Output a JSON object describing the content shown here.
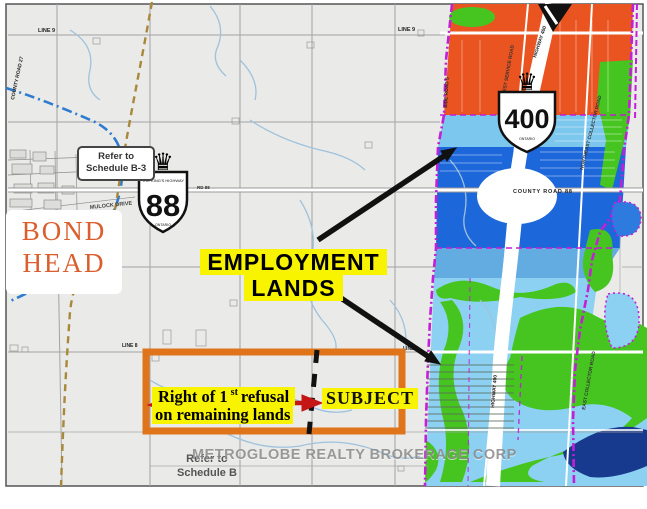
{
  "labels": {
    "bond_head": {
      "line1": "BOND",
      "line2": "HEAD"
    },
    "employment": {
      "line1": "EMPLOYMENT",
      "line2": "LANDS"
    },
    "refusal": {
      "pre": "Right of 1",
      "sup": "st",
      "post": " refusal",
      "line2": "on remaining lands"
    },
    "subject": "SUBJECT",
    "refer_b3": {
      "line1": "Refer to",
      "line2": "Schedule B-3"
    },
    "refer_b": {
      "line1": "Refer to",
      "line2": "Schedule B"
    },
    "watermark": "METROGLOBE REALTY BROKERAGE CORP"
  },
  "roads": {
    "line9_left": "LINE 9",
    "line9_right": "LINE 9",
    "line8_left": "LINE 8",
    "line8_right": "LINE 8",
    "county_road_27": "COUNTY ROAD 27",
    "mulock_drive": "MULOCK DRIVE",
    "rd_88": "RD 88",
    "county_road_88": "COUNTY ROAD 88",
    "highway_400_top": "HIGHWAY 400",
    "highway_400_bottom": "HIGHWAY 400",
    "northwest_service_road": "NORTHWEST SERVICE ROAD",
    "northeast_collector_road": "NORTHEAST COLLECTOR ROAD",
    "east_collector_road": "EAST COLLECTOR ROAD",
    "side_road_5": "SIDE ROAD 5"
  },
  "shields": {
    "hwy88": {
      "crown_icon": "♛",
      "banner": "THE KING'S HIGHWAY",
      "number": "88",
      "province": "ONTARIO"
    },
    "hwy400": {
      "crown_icon": "♛",
      "number": "400",
      "province": "ONTARIO"
    }
  },
  "colors": {
    "zone_orange": "#E95420",
    "zone_light_blue": "#7CC7ED",
    "zone_royal_blue": "#1C67DA",
    "zone_mid_blue": "#63ACE2",
    "zone_pale_blue": "#8DD1F2",
    "zone_green": "#46C521",
    "zone_navy": "#17398E",
    "boundary_purple": "#C21FD6",
    "highlight_yellow": "#F8F400",
    "annotation_orange": "#E0741A",
    "arrow_red": "#C41616",
    "bond_head_orange": "#DB5F2E",
    "map_background": "#EAEAE8"
  }
}
